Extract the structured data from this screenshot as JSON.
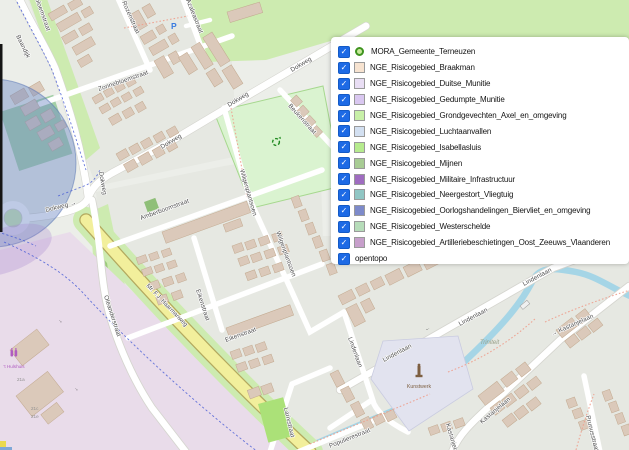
{
  "legend": {
    "check_glyph": "✓",
    "items": [
      {
        "label": "MORA_Gemeente_Terneuzen",
        "type": "marker",
        "color": "#4f9e2f"
      },
      {
        "label": "NGE_Risicogebied_Braakman",
        "type": "swatch",
        "color": "#f7e3d0"
      },
      {
        "label": "NGE_Risicogebied_Duitse_Munitie",
        "type": "swatch",
        "color": "#e9def4"
      },
      {
        "label": "NGE_Risicogebied_Gedumpte_Munitie",
        "type": "swatch",
        "color": "#d9c7f0"
      },
      {
        "label": "NGE_Risicogebied_Grondgevechten_Axel_en_omgeving",
        "type": "swatch",
        "color": "#c8f0a8"
      },
      {
        "label": "NGE_Risicogebied_Luchtaanvallen",
        "type": "swatch",
        "color": "#d3e0f1"
      },
      {
        "label": "NGE_Risicogebied_Isabellasluis",
        "type": "swatch",
        "color": "#b6eb8e"
      },
      {
        "label": "NGE_Risicogebied_Mijnen",
        "type": "swatch",
        "color": "#a8cc94"
      },
      {
        "label": "NGE_Risicogebied_Militaire_Infrastructuur",
        "type": "swatch",
        "color": "#9f6cc0"
      },
      {
        "label": "NGE_Risicogebied_Neergestort_Vliegtuig",
        "type": "swatch",
        "color": "#90c6c4"
      },
      {
        "label": "NGE_Risicogebied_Oorlogshandelingen_Biervliet_en_omgeving",
        "type": "swatch",
        "color": "#7d8aca"
      },
      {
        "label": "NGE_Risicogebied_Westerschelde",
        "type": "swatch",
        "color": "#b6dcb9"
      },
      {
        "label": "NGE_Risicogebied_Artilleriebeschietingen_Oost_Zeeuws_Vlaanderen",
        "type": "swatch",
        "color": "#c79fcb"
      },
      {
        "label": "opentopo",
        "type": "none",
        "color": ""
      }
    ]
  },
  "map": {
    "street_labels": [
      {
        "text": "Baandijk"
      },
      {
        "text": "Zonnebloemstraat"
      },
      {
        "text": "Rozenstraat"
      },
      {
        "text": "Azaleastraat"
      },
      {
        "text": "Zonnebloemstraat"
      },
      {
        "text": "Dokweg"
      },
      {
        "text": "Dokweg"
      },
      {
        "text": "Dokweg"
      },
      {
        "text": "Dokweg →"
      },
      {
        "text": "Dokweg"
      },
      {
        "text": "Amberboomstraat"
      },
      {
        "text": "Oleanderstraat"
      },
      {
        "text": "Eikenstraat"
      },
      {
        "text": "Eikenstraat"
      },
      {
        "text": "Larixstraat"
      },
      {
        "text": "Wilgenplantsoen"
      },
      {
        "text": "Wilgenplantsoen"
      },
      {
        "text": "Beukenstraat"
      },
      {
        "text": "Mr. F.J. Haarmanweg"
      },
      {
        "text": "Lindenlaan"
      },
      {
        "text": "Lindenlaan"
      },
      {
        "text": "Lindenlaan"
      },
      {
        "text": "Lindenlaan"
      },
      {
        "text": "→ Kastanjelaan"
      },
      {
        "text": "Kastanjelaan"
      },
      {
        "text": "Kastanjelaan"
      },
      {
        "text": "Prunusstraat"
      },
      {
        "text": "Populierestraat"
      }
    ],
    "poi": {
      "parking_icon": "P",
      "area_label": "Triniteit",
      "monument_label": "Kunstwerk",
      "shop_label": "'t Hulshuis",
      "house_numbers": [
        "21a",
        "21c",
        "21e"
      ],
      "arrow_right": "→",
      "arrow_left": "←"
    }
  }
}
